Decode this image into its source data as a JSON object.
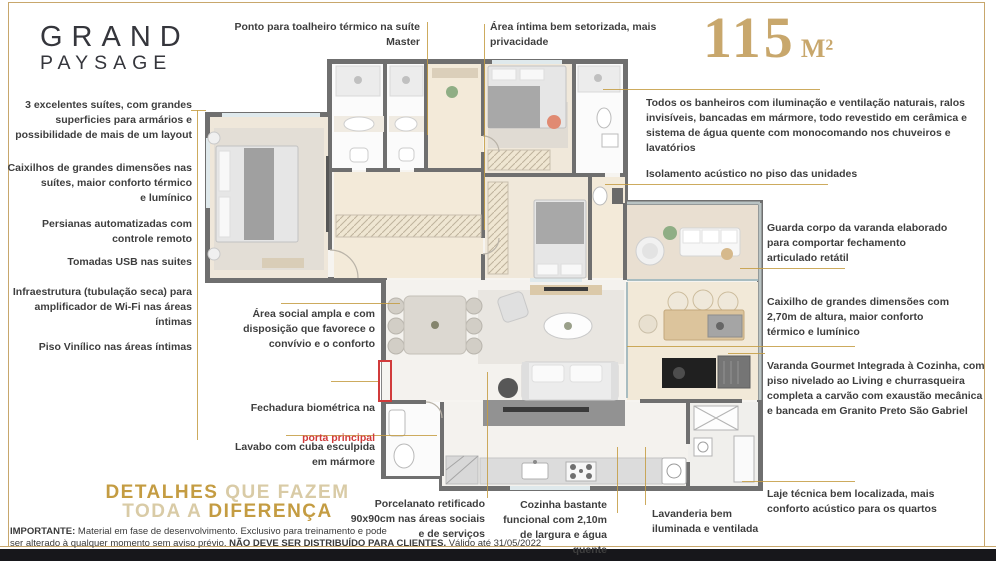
{
  "brand": {
    "name": "GRAND PAYSAGE",
    "line1": "GRAND",
    "line2": "PAYSAGE"
  },
  "badge": {
    "area": "115",
    "unit": "M²"
  },
  "annotations": {
    "top": [
      {
        "text": "Ponto para toalheiro térmico na suíte\nMaster"
      },
      {
        "text": "Área íntima bem setorizada, mais\nprivacidade"
      }
    ],
    "left": [
      {
        "text": "3 excelentes suítes, com grandes\nsuperficies para armários e\npossibilidade de mais de um layout"
      },
      {
        "text": "Caixilhos de grandes dimensões nas\nsuítes, maior conforto térmico\ne lumínico"
      },
      {
        "text": "Persianas automatizadas com\ncontrole remoto"
      },
      {
        "text": "Tomadas USB nas suites"
      },
      {
        "text": "Infraestrutura (tubulação seca) para\namplificador de Wi-Fi nas áreas\níntimas"
      },
      {
        "text": "Piso Vinílico nas áreas íntimas"
      }
    ],
    "mid": [
      {
        "text": "Área social ampla e com\ndisposição que favorece o\nconvívio e o conforto"
      },
      {
        "prefix": "Fechadura biométrica na",
        "highlight": "porta principal"
      },
      {
        "text": "Lavabo com cuba esculpida\nem mármore"
      }
    ],
    "right": [
      {
        "text": "Todos os banheiros com iluminação e ventilação naturais, ralos\ninvisíveis, bancadas em mármore, todo revestido em cerâmica e\nsistema de água quente com monocomando nos chuveiros e\nlavatórios"
      },
      {
        "text": "Isolamento acústico no piso das unidades"
      },
      {
        "text": "Guarda corpo da varanda elaborado\npara comportar fechamento\narticulado retátil"
      },
      {
        "text": "Caixilho de grandes dimensões com\n2,70m de altura, maior conforto\ntérmico e lumínico"
      },
      {
        "text": "Varanda Gourmet Integrada à Cozinha, com\npiso nivelado ao Living e churrasqueira\ncompleta a carvão com exaustão mecânica\ne bancada em Granito Preto São Gabriel"
      },
      {
        "text": "Laje técnica bem localizada, mais\nconforto acústico para os quartos"
      }
    ],
    "bottom": [
      {
        "text": "Porcelanato retificado\n90x90cm nas áreas sociais\ne de serviços"
      },
      {
        "text": "Cozinha bastante\nfuncional com 2,10m\nde largura e água\nquente"
      },
      {
        "text": "Lavanderia bem\niluminada e ventilada"
      }
    ]
  },
  "tagline": {
    "l1_strong": "DETALHES",
    "l1_light": " QUE FAZEM",
    "l2_light": "TODA A ",
    "l2_strong": "DIFERENÇA"
  },
  "disclaimer": {
    "bold1": "IMPORTANTE:",
    "text1": " Material em fase de desenvolvimento.  Exclusivo para treinamento e pode",
    "text2a": "ser alterado à qualquer momento sem aviso prévio. ",
    "bold2": "NÃO DEVE SER DISTRIBUÍDO PARA CLIENTES.",
    "text2b": " Válido até 31/05/2022"
  },
  "colors": {
    "gold": "#c49c42",
    "gold_soft": "#d9cba6",
    "gold_badge": "#c8a76c",
    "red": "#d13b3b",
    "text": "#3e3e3e",
    "wall": "#707070"
  }
}
